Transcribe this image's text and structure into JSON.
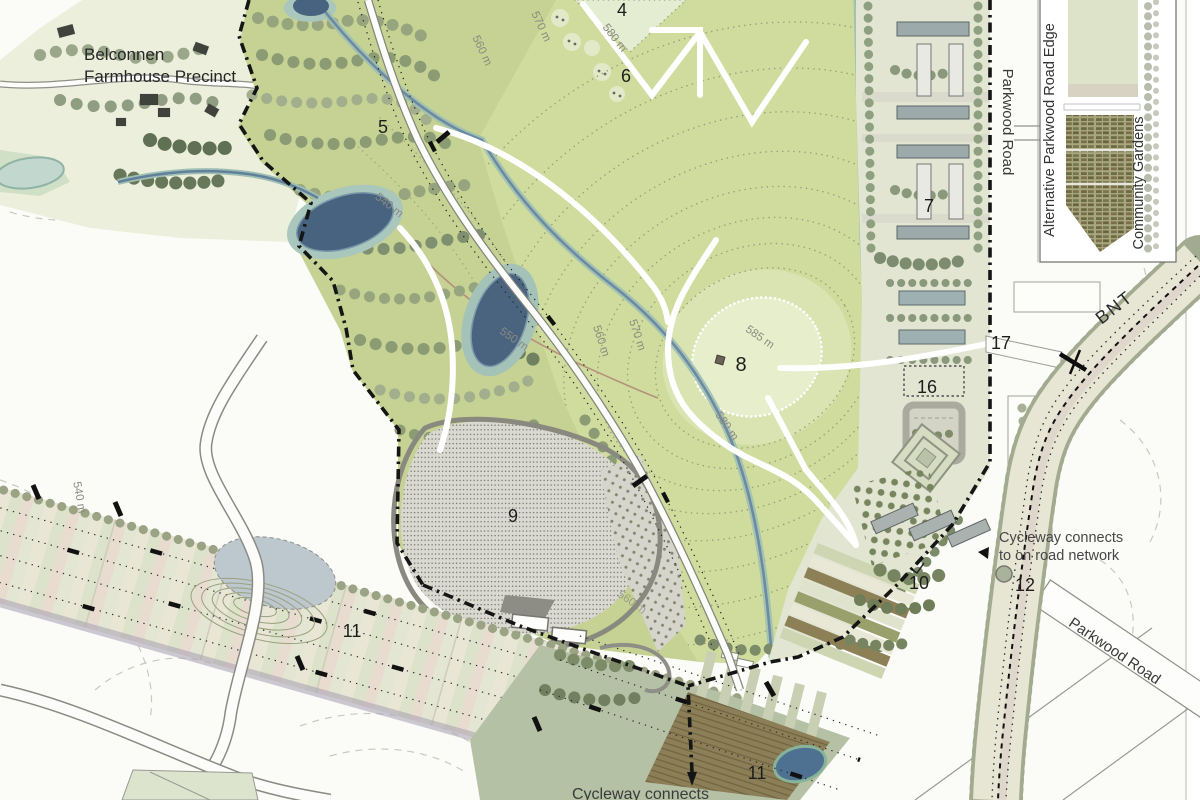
{
  "map_title": "Parkland / Belconnen master plan extract",
  "labels": {
    "belconnen_line1": "Belconnen",
    "belconnen_line2": "Farmhouse Precinct",
    "parkwood_vertical": "Parkwood Road",
    "parkwood_diagonal": "Parkwood Road",
    "bnt": "BNT",
    "cycleway_right_line1": "Cycleway connects",
    "cycleway_right_line2": "to on road network",
    "cycleway_bottom": "Cycleway connects"
  },
  "legend": {
    "alternative_edge": "Alternative Parkwood Road Edge",
    "community_gardens": "Community Gardens"
  },
  "areas": {
    "n4": "4",
    "n5": "5",
    "n6": "6",
    "n7": "7",
    "n8": "8",
    "n9": "9",
    "n10": "10",
    "n11a": "11",
    "n11b": "11",
    "n12": "12",
    "n16": "16",
    "n17": "17"
  },
  "contours": {
    "c540a": "540 m",
    "c540b": "540 m",
    "c550": "550 m",
    "c560a": "560 m",
    "c560b": "560 m",
    "c560c": "560 m",
    "c570a": "570 m",
    "c570b": "570 m",
    "c580a": "580 m",
    "c580b": "580 m",
    "c585": "585 m"
  },
  "colors": {
    "field_green": "#cfdc9d",
    "summit_green": "#e6eecb",
    "woodland_green": "#b3c295",
    "water_dark": "#4a6580",
    "wetland_teal": "#a9c7bc",
    "corridor_beige": "#e8e6d8",
    "building_grey": "#9caaac",
    "orchard_olive": "#77855e",
    "allotment_olive": "#6c6a40",
    "brown_band": "#8c7f58",
    "boundary_black": "#151515",
    "road_casing": "#8b8b84"
  }
}
